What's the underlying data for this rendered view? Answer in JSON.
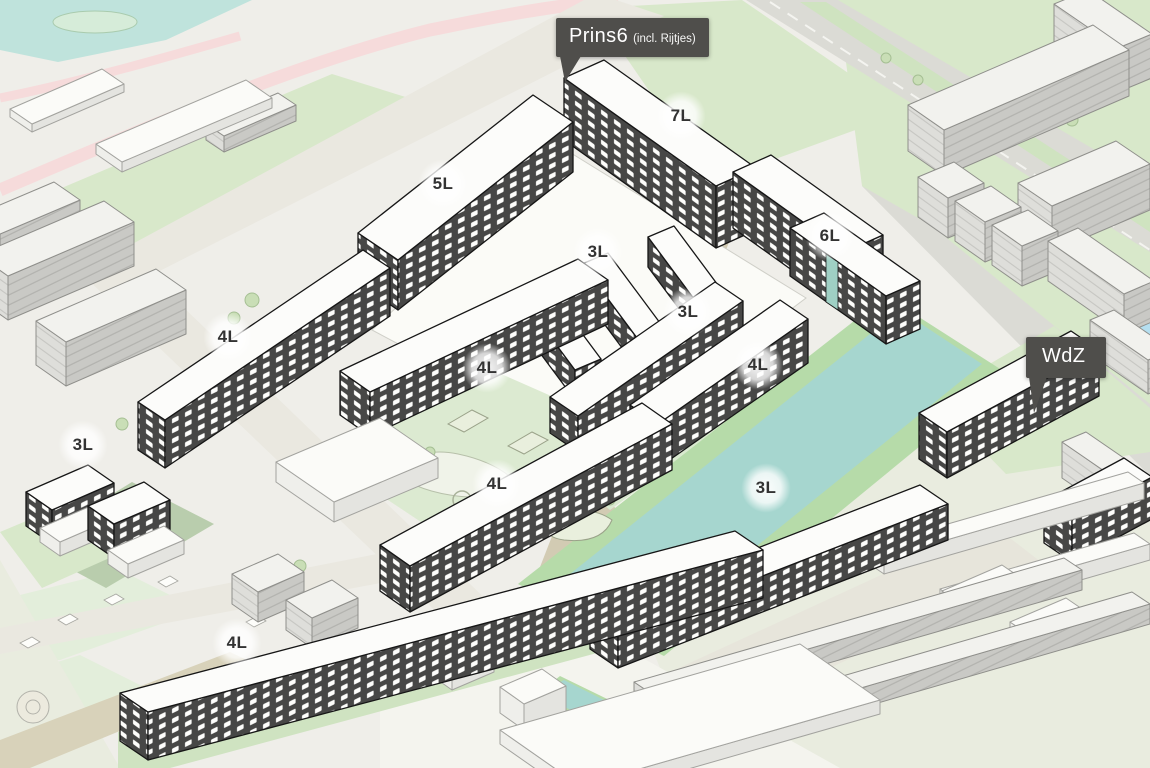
{
  "view": {
    "kind": "3d-planning-map",
    "width": 1150,
    "height": 768
  },
  "tooltips": [
    {
      "id": "prins6",
      "title": "Prins6",
      "subtitle": "(incl. Rijtjes)"
    },
    {
      "id": "wdz",
      "title": "WdZ",
      "subtitle": ""
    }
  ],
  "floor_labels": [
    {
      "text": "7L"
    },
    {
      "text": "5L"
    },
    {
      "text": "3L"
    },
    {
      "text": "6L"
    },
    {
      "text": "4L"
    },
    {
      "text": "3L"
    },
    {
      "text": "4L"
    },
    {
      "text": "4L"
    },
    {
      "text": "3L"
    },
    {
      "text": "4L"
    },
    {
      "text": "3L"
    },
    {
      "text": "4L"
    }
  ],
  "colors": {
    "background": "#efeee9",
    "greenery": "#d8e8ca",
    "courtyard_green": "#dcead1",
    "water": "#a6d6cf",
    "water_light": "#bfe3dc",
    "road": "#dbdbd5",
    "path_tan": "#d2cbb3",
    "path_pink": "#f6dbdb",
    "plan_facade": "#474746",
    "plan_roof": "#fcfcfa",
    "context_wall": "#c9c9c5",
    "tooltip_background": "#4f4e4b",
    "label_text": "#333333"
  }
}
